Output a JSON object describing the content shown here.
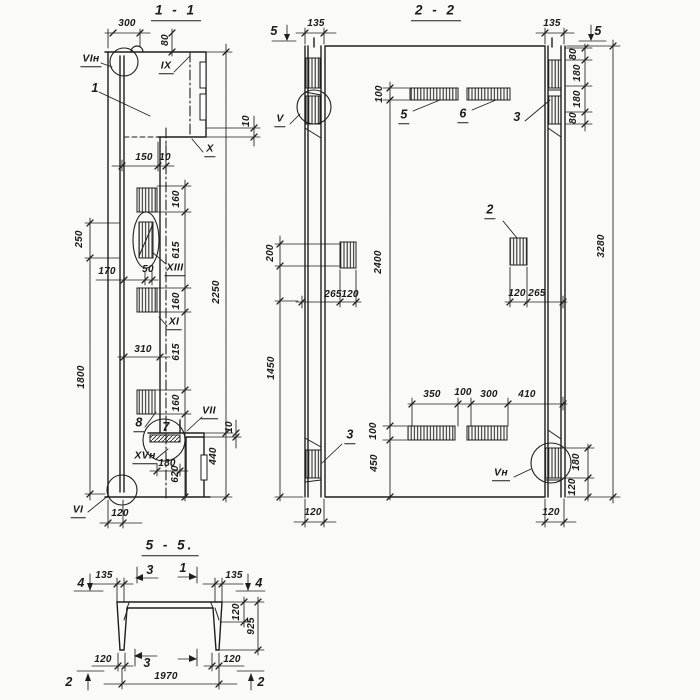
{
  "drawing": {
    "type": "structural-reinforced-concrete-panel-working-drawing",
    "colors": {
      "background": "#fafaf8",
      "line": "#1e1e1e"
    },
    "sections": [
      {
        "id": "section-1-1",
        "title": "1 - 1"
      },
      {
        "id": "section-2-2",
        "title": "2 - 2"
      },
      {
        "id": "section-5-5",
        "title": "5 - 5."
      }
    ],
    "labels": [
      {
        "n": "dim-300",
        "t": "300",
        "x": 127,
        "y": 24
      },
      {
        "n": "dim-80-cap",
        "t": "80",
        "x": 166,
        "y": 40,
        "r": 1
      },
      {
        "n": "view-mark-vi-n-top",
        "t": "VIн",
        "x": 91,
        "y": 60,
        "u": 1,
        "c": "mark"
      },
      {
        "n": "callout-1",
        "t": "1",
        "x": 95,
        "y": 88,
        "c": "callout"
      },
      {
        "n": "view-mark-ix",
        "t": "IX",
        "x": 166,
        "y": 67,
        "u": 1,
        "c": "mark"
      },
      {
        "n": "dim-10-notch",
        "t": "10",
        "x": 247,
        "y": 121,
        "r": 1
      },
      {
        "n": "view-mark-x",
        "t": "X",
        "x": 210,
        "y": 150,
        "u": 1,
        "c": "mark"
      },
      {
        "n": "dim-150",
        "t": "150",
        "x": 144,
        "y": 158
      },
      {
        "n": "dim-10-top",
        "t": "10",
        "x": 165,
        "y": 158
      },
      {
        "n": "dim-160-a",
        "t": "160",
        "x": 177,
        "y": 199,
        "r": 1
      },
      {
        "n": "dim-250",
        "t": "250",
        "x": 80,
        "y": 239,
        "r": 1
      },
      {
        "n": "dim-615-a",
        "t": "615",
        "x": 177,
        "y": 250,
        "r": 1
      },
      {
        "n": "dim-170",
        "t": "170",
        "x": 107,
        "y": 272
      },
      {
        "n": "dim-50",
        "t": "50",
        "x": 148,
        "y": 270
      },
      {
        "n": "view-mark-xiii",
        "t": "XIII",
        "x": 175,
        "y": 269,
        "u": 1,
        "c": "mark"
      },
      {
        "n": "dim-2250",
        "t": "2250",
        "x": 217,
        "y": 292,
        "r": 1
      },
      {
        "n": "dim-160-b",
        "t": "160",
        "x": 177,
        "y": 301,
        "r": 1
      },
      {
        "n": "view-mark-xi",
        "t": "XI",
        "x": 174,
        "y": 323,
        "u": 1,
        "c": "mark"
      },
      {
        "n": "dim-310",
        "t": "310",
        "x": 143,
        "y": 350
      },
      {
        "n": "dim-615-b",
        "t": "615",
        "x": 177,
        "y": 352,
        "r": 1
      },
      {
        "n": "dim-1800",
        "t": "1800",
        "x": 82,
        "y": 377,
        "r": 1
      },
      {
        "n": "dim-160-c",
        "t": "160",
        "x": 177,
        "y": 403,
        "r": 1
      },
      {
        "n": "callout-8",
        "t": "8",
        "x": 139,
        "y": 424,
        "u": 1,
        "c": "callout"
      },
      {
        "n": "callout-7",
        "t": "7",
        "x": 166,
        "y": 427,
        "c": "callout"
      },
      {
        "n": "view-mark-vii",
        "t": "VII",
        "x": 209,
        "y": 412,
        "u": 1,
        "c": "mark"
      },
      {
        "n": "dim-10-seat",
        "t": "10",
        "x": 230,
        "y": 427,
        "r": 1
      },
      {
        "n": "view-mark-xv-n",
        "t": "XVн",
        "x": 145,
        "y": 457,
        "u": 1,
        "c": "mark"
      },
      {
        "n": "dim-180-seat",
        "t": "180",
        "x": 167,
        "y": 464
      },
      {
        "n": "dim-440",
        "t": "440",
        "x": 214,
        "y": 456,
        "r": 1
      },
      {
        "n": "dim-620",
        "t": "620",
        "x": 176,
        "y": 474,
        "r": 1
      },
      {
        "n": "view-mark-vi-bottom",
        "t": "VI",
        "x": 78,
        "y": 511,
        "u": 1,
        "c": "mark"
      },
      {
        "n": "dim-120-flange",
        "t": "120",
        "x": 120,
        "y": 514
      },
      {
        "n": "cut-mark-5-left",
        "t": "5",
        "x": 274,
        "y": 31,
        "c": "callout"
      },
      {
        "n": "dim-135-left",
        "t": "135",
        "x": 316,
        "y": 24
      },
      {
        "n": "dim-135-right",
        "t": "135",
        "x": 552,
        "y": 24
      },
      {
        "n": "cut-mark-5-right",
        "t": "5",
        "x": 598,
        "y": 31,
        "c": "callout"
      },
      {
        "n": "dim-80-top-a",
        "t": "80",
        "x": 574,
        "y": 54,
        "r": 1
      },
      {
        "n": "dim-180-top-a",
        "t": "180",
        "x": 578,
        "y": 73,
        "r": 1
      },
      {
        "n": "dim-180-top-b",
        "t": "180",
        "x": 578,
        "y": 99,
        "r": 1
      },
      {
        "n": "dim-80-top-b",
        "t": "80",
        "x": 574,
        "y": 118,
        "r": 1
      },
      {
        "n": "dim-100-top",
        "t": "100",
        "x": 380,
        "y": 94,
        "r": 1
      },
      {
        "n": "callout-5",
        "t": "5",
        "x": 404,
        "y": 116,
        "u": 1,
        "c": "callout"
      },
      {
        "n": "callout-6",
        "t": "6",
        "x": 463,
        "y": 115,
        "u": 1,
        "c": "callout"
      },
      {
        "n": "callout-3-top",
        "t": "3",
        "x": 517,
        "y": 117,
        "c": "callout"
      },
      {
        "n": "view-mark-v",
        "t": "V",
        "x": 280,
        "y": 120,
        "u": 1,
        "c": "mark"
      },
      {
        "n": "dim-200",
        "t": "200",
        "x": 271,
        "y": 253,
        "r": 1
      },
      {
        "n": "dim-2400",
        "t": "2400",
        "x": 379,
        "y": 262,
        "r": 1
      },
      {
        "n": "dim-265-left",
        "t": "265",
        "x": 333,
        "y": 295
      },
      {
        "n": "dim-120-mid-left",
        "t": "120",
        "x": 350,
        "y": 295
      },
      {
        "n": "callout-2",
        "t": "2",
        "x": 490,
        "y": 211,
        "u": 1,
        "c": "callout"
      },
      {
        "n": "dim-120-mid-right",
        "t": "120",
        "x": 517,
        "y": 294
      },
      {
        "n": "dim-265-right",
        "t": "265",
        "x": 537,
        "y": 294
      },
      {
        "n": "dim-3280",
        "t": "3280",
        "x": 602,
        "y": 246,
        "r": 1
      },
      {
        "n": "dim-1450",
        "t": "1450",
        "x": 272,
        "y": 368,
        "r": 1
      },
      {
        "n": "dim-350",
        "t": "350",
        "x": 432,
        "y": 395
      },
      {
        "n": "dim-100-gap",
        "t": "100",
        "x": 463,
        "y": 393
      },
      {
        "n": "dim-300-plate",
        "t": "300",
        "x": 489,
        "y": 395
      },
      {
        "n": "dim-410",
        "t": "410",
        "x": 527,
        "y": 395
      },
      {
        "n": "dim-100-bottom",
        "t": "100",
        "x": 374,
        "y": 431,
        "r": 1
      },
      {
        "n": "callout-3-bottom",
        "t": "3",
        "x": 350,
        "y": 436,
        "u": 1,
        "c": "callout"
      },
      {
        "n": "dim-450",
        "t": "450",
        "x": 375,
        "y": 463,
        "r": 1
      },
      {
        "n": "view-mark-v-n",
        "t": "Vн",
        "x": 501,
        "y": 474,
        "u": 1,
        "c": "mark"
      },
      {
        "n": "dim-180-bottom",
        "t": "180",
        "x": 577,
        "y": 462,
        "r": 1
      },
      {
        "n": "dim-120-bottom-chain",
        "t": "120",
        "x": 573,
        "y": 487,
        "r": 1
      },
      {
        "n": "dim-120-rib-left",
        "t": "120",
        "x": 313,
        "y": 513
      },
      {
        "n": "dim-120-rib-right",
        "t": "120",
        "x": 551,
        "y": 513
      },
      {
        "n": "cut-mark-4-left",
        "t": "4",
        "x": 81,
        "y": 583,
        "c": "callout"
      },
      {
        "n": "dim-135-leg-left",
        "t": "135",
        "x": 104,
        "y": 576
      },
      {
        "n": "cut-mark-3-top",
        "t": "3",
        "x": 150,
        "y": 570,
        "c": "callout"
      },
      {
        "n": "cut-mark-1-top",
        "t": "1",
        "x": 183,
        "y": 568,
        "c": "callout"
      },
      {
        "n": "dim-135-leg-right",
        "t": "135",
        "x": 234,
        "y": 576
      },
      {
        "n": "cut-mark-4-right",
        "t": "4",
        "x": 259,
        "y": 583,
        "c": "callout"
      },
      {
        "n": "dim-120-slab",
        "t": "120",
        "x": 237,
        "y": 612,
        "r": 1
      },
      {
        "n": "dim-925",
        "t": "925",
        "x": 252,
        "y": 626,
        "r": 1
      },
      {
        "n": "dim-120-leg-left",
        "t": "120",
        "x": 103,
        "y": 660
      },
      {
        "n": "cut-mark-3-bottom",
        "t": "3",
        "x": 147,
        "y": 663,
        "c": "callout"
      },
      {
        "n": "dim-120-leg-right",
        "t": "120",
        "x": 232,
        "y": 660
      },
      {
        "n": "dim-1970",
        "t": "1970",
        "x": 166,
        "y": 677
      },
      {
        "n": "cut-mark-2-left",
        "t": "2",
        "x": 69,
        "y": 682,
        "c": "callout"
      },
      {
        "n": "cut-mark-2-right",
        "t": "2",
        "x": 261,
        "y": 682,
        "c": "callout"
      }
    ]
  }
}
